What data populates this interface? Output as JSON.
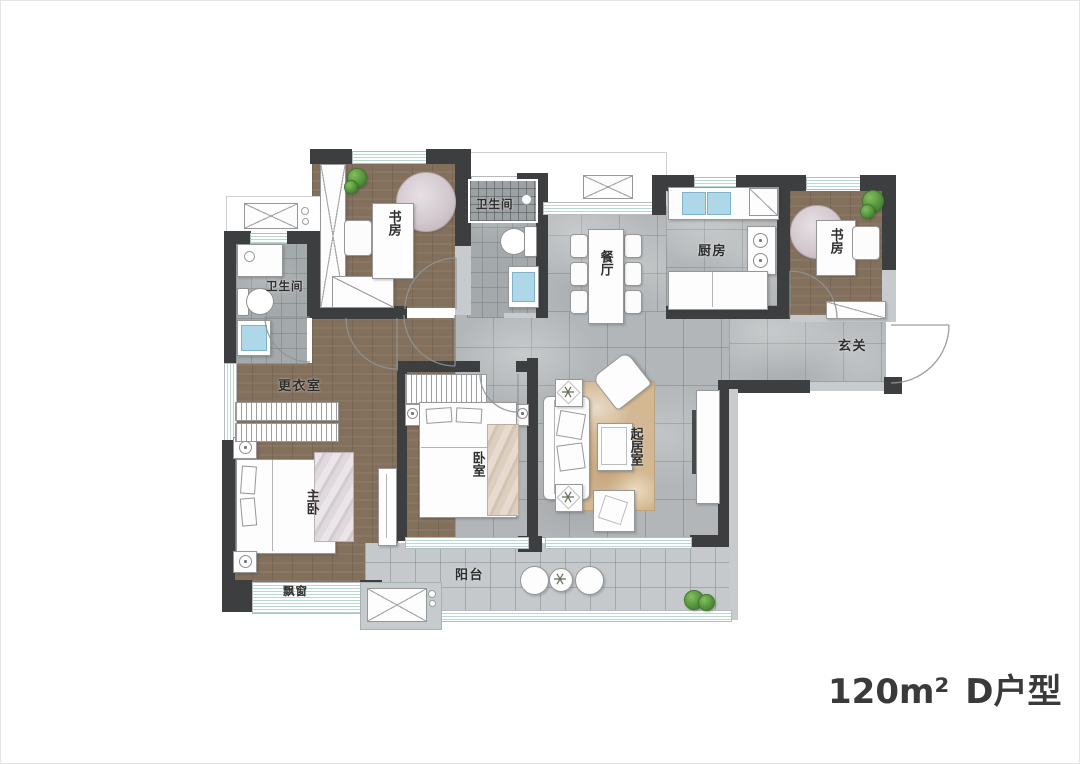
{
  "floorplan": {
    "unit_area": "120m²",
    "unit_type": "D户型",
    "rooms": {
      "study_left": "书房",
      "bath_top": "卫生间",
      "bath_left": "卫生间",
      "dining": "餐厅",
      "kitchen": "厨房",
      "study_right": "书房",
      "foyer": "玄关",
      "dressing_room": "更衣室",
      "master_bedroom": "主卧",
      "bedroom": "卧室",
      "living_room": "起居室",
      "balcony": "阳台",
      "bay_window": "飘窗"
    },
    "colors": {
      "wall_dark": "#3d3e40",
      "wall_light": "#c7cbcd",
      "wood_floor": "#83705c",
      "tile_floor": "#b2b6b8",
      "bath_tile": "#a4a9ab",
      "balcony_tile": "#c5c9cb",
      "rug_tan": "#d3b891",
      "fixture_blue": "#aed8ea",
      "plant_green": "#55953c",
      "label_text": "#2e2e2e"
    }
  }
}
